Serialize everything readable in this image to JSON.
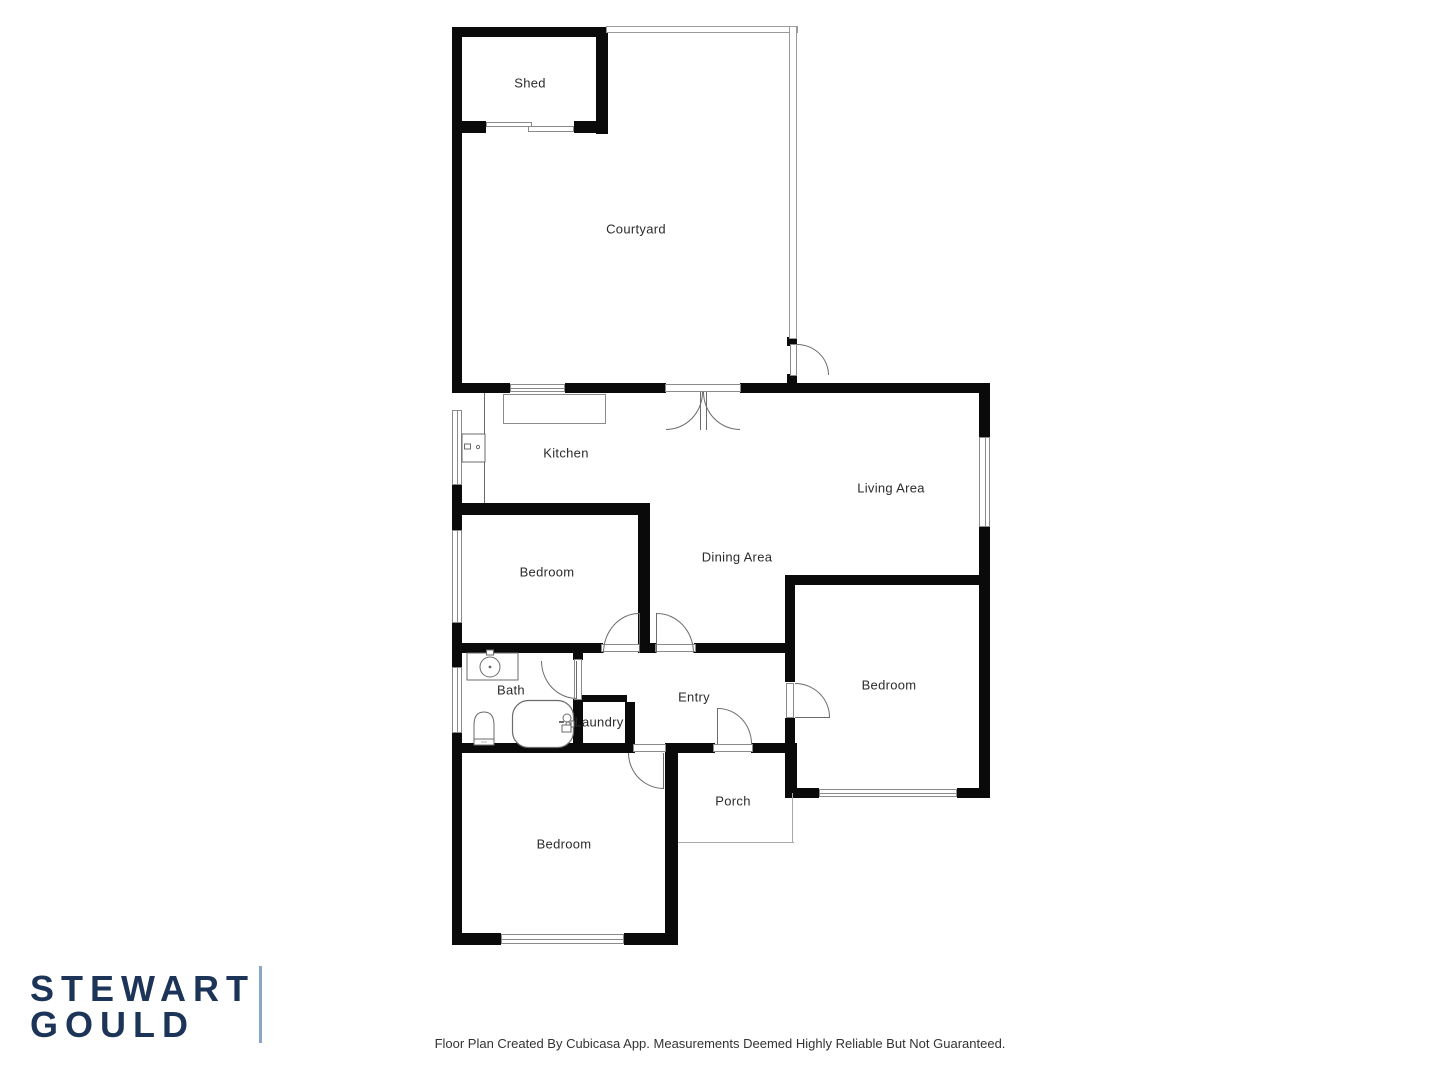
{
  "branding": {
    "logo_line1": "STEWART",
    "logo_line2": "GOULD",
    "logo_color": "#1c3457",
    "divider_color": "#8aa6c6"
  },
  "footer": {
    "disclaimer": "Floor Plan Created By Cubicasa App. Measurements Deemed Highly Reliable But Not Guaranteed."
  },
  "floor_plan": {
    "wall_color": "#0a0a0a",
    "rooms": {
      "shed": {
        "label": "Shed"
      },
      "courtyard": {
        "label": "Courtyard"
      },
      "kitchen": {
        "label": "Kitchen"
      },
      "living_area": {
        "label": "Living Area"
      },
      "dining_area": {
        "label": "Dining Area"
      },
      "bedroom_middle": {
        "label": "Bedroom"
      },
      "bedroom_right": {
        "label": "Bedroom"
      },
      "bedroom_bottom": {
        "label": "Bedroom"
      },
      "bath": {
        "label": "Bath"
      },
      "laundry": {
        "label": "Laundry"
      },
      "entry": {
        "label": "Entry"
      },
      "porch": {
        "label": "Porch"
      }
    },
    "fixture_icons": [
      "kitchen-stove-icon",
      "kitchen-counter",
      "bath-sink-icon",
      "toilet-icon",
      "bathtub-icon",
      "laundry-tap-icon"
    ]
  }
}
